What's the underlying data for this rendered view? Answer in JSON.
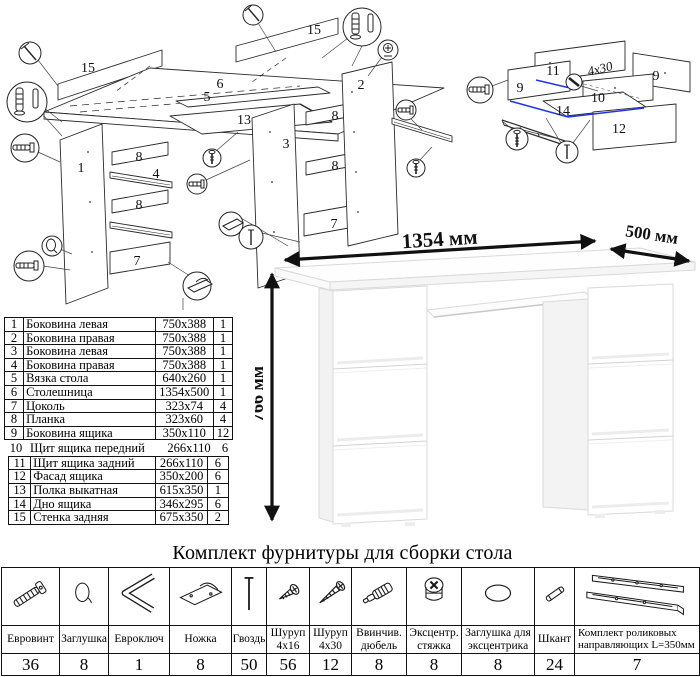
{
  "diagram_main": {
    "description": "exploded assembly view of desk",
    "labels": {
      "backpanel_a": "15",
      "top": "6",
      "backpanel_b": "15",
      "vyazka": "5",
      "shelf": "13",
      "side_left": "1",
      "plank_l1": "8",
      "rail_l": "4",
      "plank_l2": "8",
      "plinth_l": "7",
      "side_inner": "3",
      "side_right": "2",
      "plank_r1": "8",
      "plank_r2": "8",
      "plinth_r": "7"
    },
    "callout_icons": [
      "nail-icon",
      "cam-dowel-icon",
      "wooden-dowel-icon",
      "cam-lock-icon",
      "euroscrew-icon",
      "cap-icon",
      "foot-icon",
      "screw-icon"
    ]
  },
  "diagram_drawer": {
    "description": "exploded assembly view of drawer",
    "labels": {
      "back": "11",
      "side_left": "9",
      "side_right": "9",
      "front": "10",
      "bottom": "14",
      "facade": "12"
    },
    "screw_note": "4x30",
    "highlight_color": "#2233ee"
  },
  "desk_photo": {
    "width_label": "1354 мм",
    "depth_label": "500 мм",
    "height_label": "766 мм"
  },
  "parts_table": {
    "rows": [
      {
        "num": "1",
        "name": "Боковина левая",
        "size": "750x388",
        "qty": "1"
      },
      {
        "num": "2",
        "name": "Боковина правая",
        "size": "750x388",
        "qty": "1"
      },
      {
        "num": "3",
        "name": "Боковина левая",
        "size": "750x388",
        "qty": "1"
      },
      {
        "num": "4",
        "name": "Боковина правая",
        "size": "750x388",
        "qty": "1"
      },
      {
        "num": "5",
        "name": "Вязка стола",
        "size": "640x260",
        "qty": "1"
      },
      {
        "num": "6",
        "name": "Столешница",
        "size": "1354x500",
        "qty": "1"
      },
      {
        "num": "7",
        "name": "Цоколь",
        "size": "323x74",
        "qty": "4"
      },
      {
        "num": "8",
        "name": "Планка",
        "size": "323x60",
        "qty": "4"
      },
      {
        "num": "9",
        "name": "Боковина ящика",
        "size": "350x110",
        "qty": "12"
      },
      {
        "num": "10",
        "name": "Щит ящика передний",
        "size": "266x110",
        "qty": "6"
      },
      {
        "num": "11",
        "name": "Щит ящика задний",
        "size": "266x110",
        "qty": "6"
      },
      {
        "num": "12",
        "name": "Фасад ящика",
        "size": "350x200",
        "qty": "6"
      },
      {
        "num": "13",
        "name": "Полка выкатная",
        "size": "615x350",
        "qty": "1"
      },
      {
        "num": "14",
        "name": "Дно ящика",
        "size": "346x295",
        "qty": "6"
      },
      {
        "num": "15",
        "name": "Стенка задняя",
        "size": "675x350",
        "qty": "2"
      }
    ]
  },
  "hardware": {
    "title": "Комплект фурнитуры для сборки стола",
    "items": [
      {
        "label": "Евровинт",
        "qty": "36",
        "icon": "euroscrew-icon"
      },
      {
        "label": "Заглушка",
        "qty": "8",
        "icon": "cap-icon"
      },
      {
        "label": "Евроключ",
        "qty": "1",
        "icon": "hex-key-icon"
      },
      {
        "label": "Ножка",
        "qty": "8",
        "icon": "foot-icon"
      },
      {
        "label": "Гвоздь",
        "qty": "50",
        "icon": "nail-icon"
      },
      {
        "label": "Шуруп 4x16",
        "qty": "56",
        "icon": "screw-short-icon"
      },
      {
        "label": "Шуруп 4x30",
        "qty": "12",
        "icon": "screw-long-icon"
      },
      {
        "label": "Ввинчив. дюбель",
        "qty": "8",
        "icon": "screw-in-dowel-icon"
      },
      {
        "label": "Эксцентр. стяжка",
        "qty": "8",
        "icon": "cam-lock-icon"
      },
      {
        "label": "Заглушка для эксцентрика",
        "qty": "8",
        "icon": "cam-cap-icon"
      },
      {
        "label": "Шкант",
        "qty": "24",
        "icon": "wooden-dowel-icon"
      },
      {
        "label": "Комплект роликовых направляющих L=350мм",
        "qty": "7",
        "icon": "roller-guides-icon"
      }
    ]
  }
}
